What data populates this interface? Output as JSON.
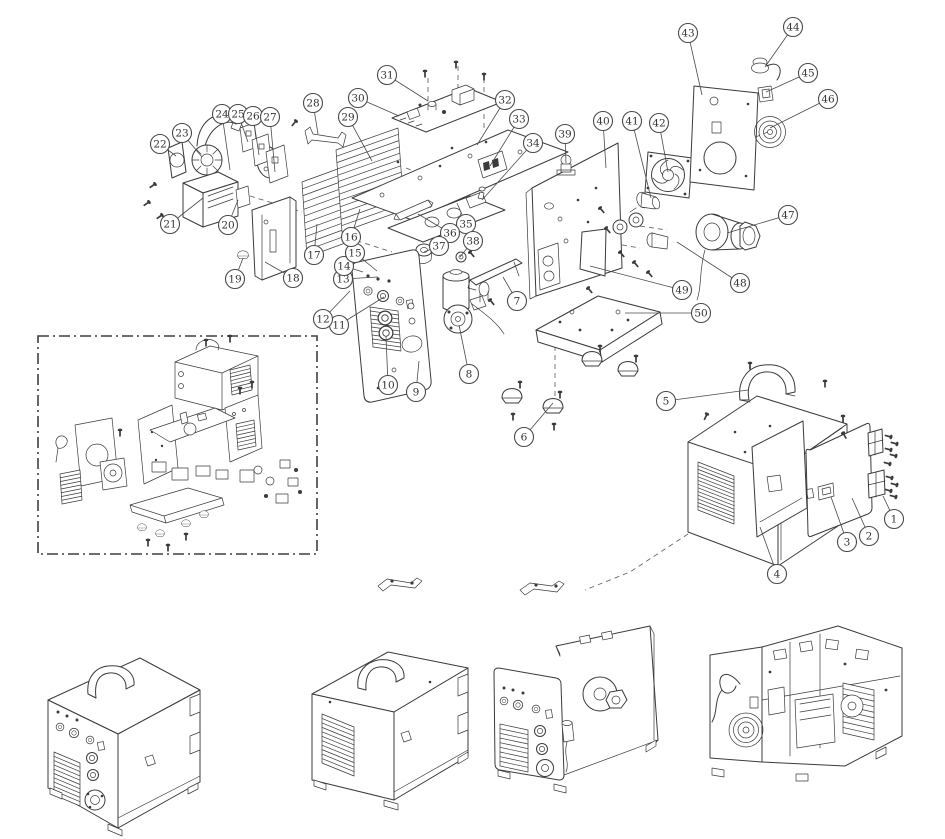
{
  "palette": {
    "background": "#ffffff",
    "line": "#3b3b3b",
    "dash_line": "#6a6a6a",
    "balloon_stroke": "#4a4a4a",
    "balloon_fill": "#ffffff",
    "number_text": "#333333"
  },
  "figure": {
    "kind": "exploded parts diagram",
    "callout_count": 50
  },
  "callouts": [
    {
      "n": "1",
      "x": 894,
      "y": 519,
      "tx": 883,
      "ty": 496
    },
    {
      "n": "2",
      "x": 869,
      "y": 536,
      "tx": 852,
      "ty": 498
    },
    {
      "n": "3",
      "x": 847,
      "y": 542,
      "tx": 831,
      "ty": 497
    },
    {
      "n": "4",
      "x": 777,
      "y": 574,
      "tx": 760,
      "ty": 527
    },
    {
      "n": "5",
      "x": 666,
      "y": 401,
      "tx": 748,
      "ty": 390
    },
    {
      "n": "6",
      "x": 524,
      "y": 437,
      "tx": 553,
      "ty": 403
    },
    {
      "n": "7",
      "x": 517,
      "y": 301,
      "tx": 503,
      "ty": 277
    },
    {
      "n": "8",
      "x": 469,
      "y": 374,
      "tx": 459,
      "ty": 325
    },
    {
      "n": "9",
      "x": 416,
      "y": 392,
      "tx": 419,
      "ty": 361
    },
    {
      "n": "10",
      "x": 388,
      "y": 385,
      "tx": 386,
      "ty": 336
    },
    {
      "n": "11",
      "x": 339,
      "y": 325,
      "tx": 384,
      "ty": 297
    },
    {
      "n": "12",
      "x": 323,
      "y": 319,
      "tx": 350,
      "ty": 291
    },
    {
      "n": "13",
      "x": 343,
      "y": 279,
      "tx": 378,
      "ty": 277
    },
    {
      "n": "14",
      "x": 344,
      "y": 266,
      "tx": 363,
      "ty": 272
    },
    {
      "n": "15",
      "x": 355,
      "y": 253,
      "tx": 377,
      "ty": 271
    },
    {
      "n": "16",
      "x": 351,
      "y": 237,
      "tx": 360,
      "ty": 209
    },
    {
      "n": "17",
      "x": 314,
      "y": 255,
      "tx": 317,
      "ty": 224
    },
    {
      "n": "18",
      "x": 293,
      "y": 278,
      "tx": 265,
      "ty": 262
    },
    {
      "n": "19",
      "x": 235,
      "y": 279,
      "tx": 243,
      "ty": 258
    },
    {
      "n": "20",
      "x": 228,
      "y": 225,
      "tx": 238,
      "ty": 200
    },
    {
      "n": "21",
      "x": 170,
      "y": 224,
      "tx": 203,
      "ty": 198
    },
    {
      "n": "22",
      "x": 160,
      "y": 144,
      "tx": 176,
      "ty": 156
    },
    {
      "n": "23",
      "x": 182,
      "y": 133,
      "tx": 202,
      "ty": 157
    },
    {
      "n": "24",
      "x": 222,
      "y": 114,
      "tx": 230,
      "ty": 170
    },
    {
      "n": "25",
      "x": 238,
      "y": 114,
      "tx": 248,
      "ty": 142
    },
    {
      "n": "26",
      "x": 253,
      "y": 116,
      "tx": 259,
      "ty": 155
    },
    {
      "n": "27",
      "x": 270,
      "y": 117,
      "tx": 275,
      "ty": 172
    },
    {
      "n": "28",
      "x": 313,
      "y": 103,
      "tx": 318,
      "ty": 134
    },
    {
      "n": "29",
      "x": 348,
      "y": 117,
      "tx": 372,
      "ty": 161
    },
    {
      "n": "30",
      "x": 358,
      "y": 98,
      "tx": 399,
      "ty": 116
    },
    {
      "n": "31",
      "x": 387,
      "y": 75,
      "tx": 428,
      "ty": 101
    },
    {
      "n": "32",
      "x": 505,
      "y": 100,
      "tx": 477,
      "ty": 145
    },
    {
      "n": "33",
      "x": 519,
      "y": 119,
      "tx": 490,
      "ty": 166
    },
    {
      "n": "34",
      "x": 533,
      "y": 143,
      "tx": 482,
      "ty": 200
    },
    {
      "n": "35",
      "x": 466,
      "y": 224,
      "tx": 457,
      "ty": 203
    },
    {
      "n": "36",
      "x": 450,
      "y": 233,
      "tx": 418,
      "ty": 214
    },
    {
      "n": "37",
      "x": 439,
      "y": 246,
      "tx": 424,
      "ty": 252
    },
    {
      "n": "38",
      "x": 473,
      "y": 241,
      "tx": 460,
      "ty": 257
    },
    {
      "n": "39",
      "x": 565,
      "y": 134,
      "tx": 566,
      "ty": 163
    },
    {
      "n": "40",
      "x": 603,
      "y": 121,
      "tx": 606,
      "ty": 168
    },
    {
      "n": "41",
      "x": 632,
      "y": 121,
      "tx": 651,
      "ty": 198
    },
    {
      "n": "42",
      "x": 659,
      "y": 123,
      "tx": 668,
      "ty": 172
    },
    {
      "n": "43",
      "x": 688,
      "y": 33,
      "tx": 702,
      "ty": 95
    },
    {
      "n": "44",
      "x": 793,
      "y": 27,
      "tx": 765,
      "ty": 67
    },
    {
      "n": "45",
      "x": 808,
      "y": 73,
      "tx": 766,
      "ty": 92
    },
    {
      "n": "46",
      "x": 828,
      "y": 99,
      "tx": 770,
      "ty": 128
    },
    {
      "n": "47",
      "x": 788,
      "y": 215,
      "tx": 727,
      "ty": 233
    },
    {
      "n": "48",
      "x": 740,
      "y": 283,
      "tx": 677,
      "ty": 242
    },
    {
      "n": "49",
      "x": 682,
      "y": 290,
      "tx": 590,
      "ty": 266
    },
    {
      "n": "50",
      "x": 701,
      "y": 313,
      "tx": 625,
      "ty": 313
    }
  ]
}
